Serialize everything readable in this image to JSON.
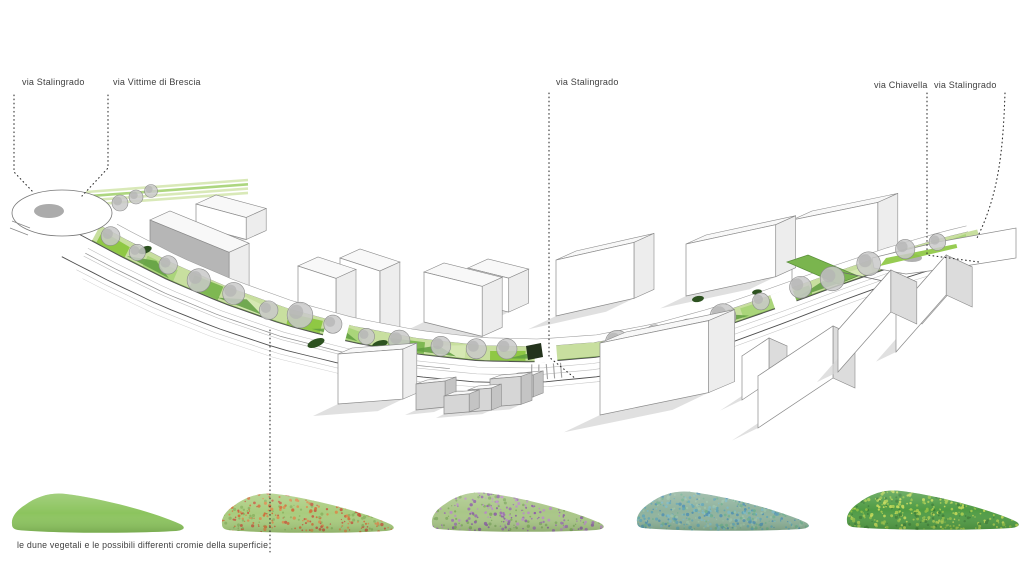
{
  "labels": [
    {
      "text": "via Stalingrado"
    },
    {
      "text": "via Vittime di Brescia"
    },
    {
      "text": "via Stalingrado"
    },
    {
      "text": "via Chiavella"
    },
    {
      "text": "via Stalingrado"
    }
  ],
  "caption": "le dune vegetali e le possibili differenti cromie della superficie",
  "colors": {
    "label": "#3f3f3f",
    "leader_line": "#2e2e2e",
    "building_front": "#ffffff",
    "building_side": "#ededed",
    "building_roof": "#f8f8f8",
    "building_stroke": "#8a8a8a",
    "building_shadow": "#d6d6d6",
    "facade_dark": "#b6b6b6",
    "small_house_front": "#d6d6d6",
    "small_house_side": "#c4c4c4",
    "road_fill": "#ffffff",
    "road_edge": "#4f4f4f",
    "road_lane": "#bdbdbd",
    "green_base": "#c8df9f",
    "green_mid": "#8cc63f",
    "green_alt1": "#a9d478",
    "green_alt2": "#7ab54e",
    "green_pale": "#d7e8b4",
    "green_mound": "#5f9e3f",
    "green_dark": "#2d5220",
    "shelter_dark": "#23331c",
    "tree_fill": "#c9c9c9",
    "tree_inner": "#b3b3b3",
    "tree_stroke": "#8c8c8c",
    "plaza_island": "#b0b0b0"
  },
  "dunes": [
    {
      "style": "solid green surface",
      "base": "#8cc45e",
      "palette": [],
      "dots": 0
    },
    {
      "style": "green with orange-red bloom speckles",
      "base": "#a9cc7e",
      "palette": [
        "#cf6a35",
        "#c5563d",
        "#d98a4a",
        "#89b35f"
      ],
      "dots": 340
    },
    {
      "style": "green with purple bloom speckles",
      "base": "#a9c687",
      "palette": [
        "#9a6fb0",
        "#b88cc4",
        "#8a5da3",
        "#7fa95f"
      ],
      "dots": 330
    },
    {
      "style": "blue-teal mottled surface",
      "base": "#8fb29d",
      "palette": [
        "#5fa3b5",
        "#4f8fb0",
        "#6fae8f",
        "#7db8c2",
        "#9ac0a8"
      ],
      "dots": 560
    },
    {
      "style": "dark green with yellow-green speckles",
      "base": "#4f9b44",
      "palette": [
        "#a7cc4e",
        "#c3d957",
        "#3b7d35",
        "#8fbf45"
      ],
      "dots": 430
    }
  ]
}
